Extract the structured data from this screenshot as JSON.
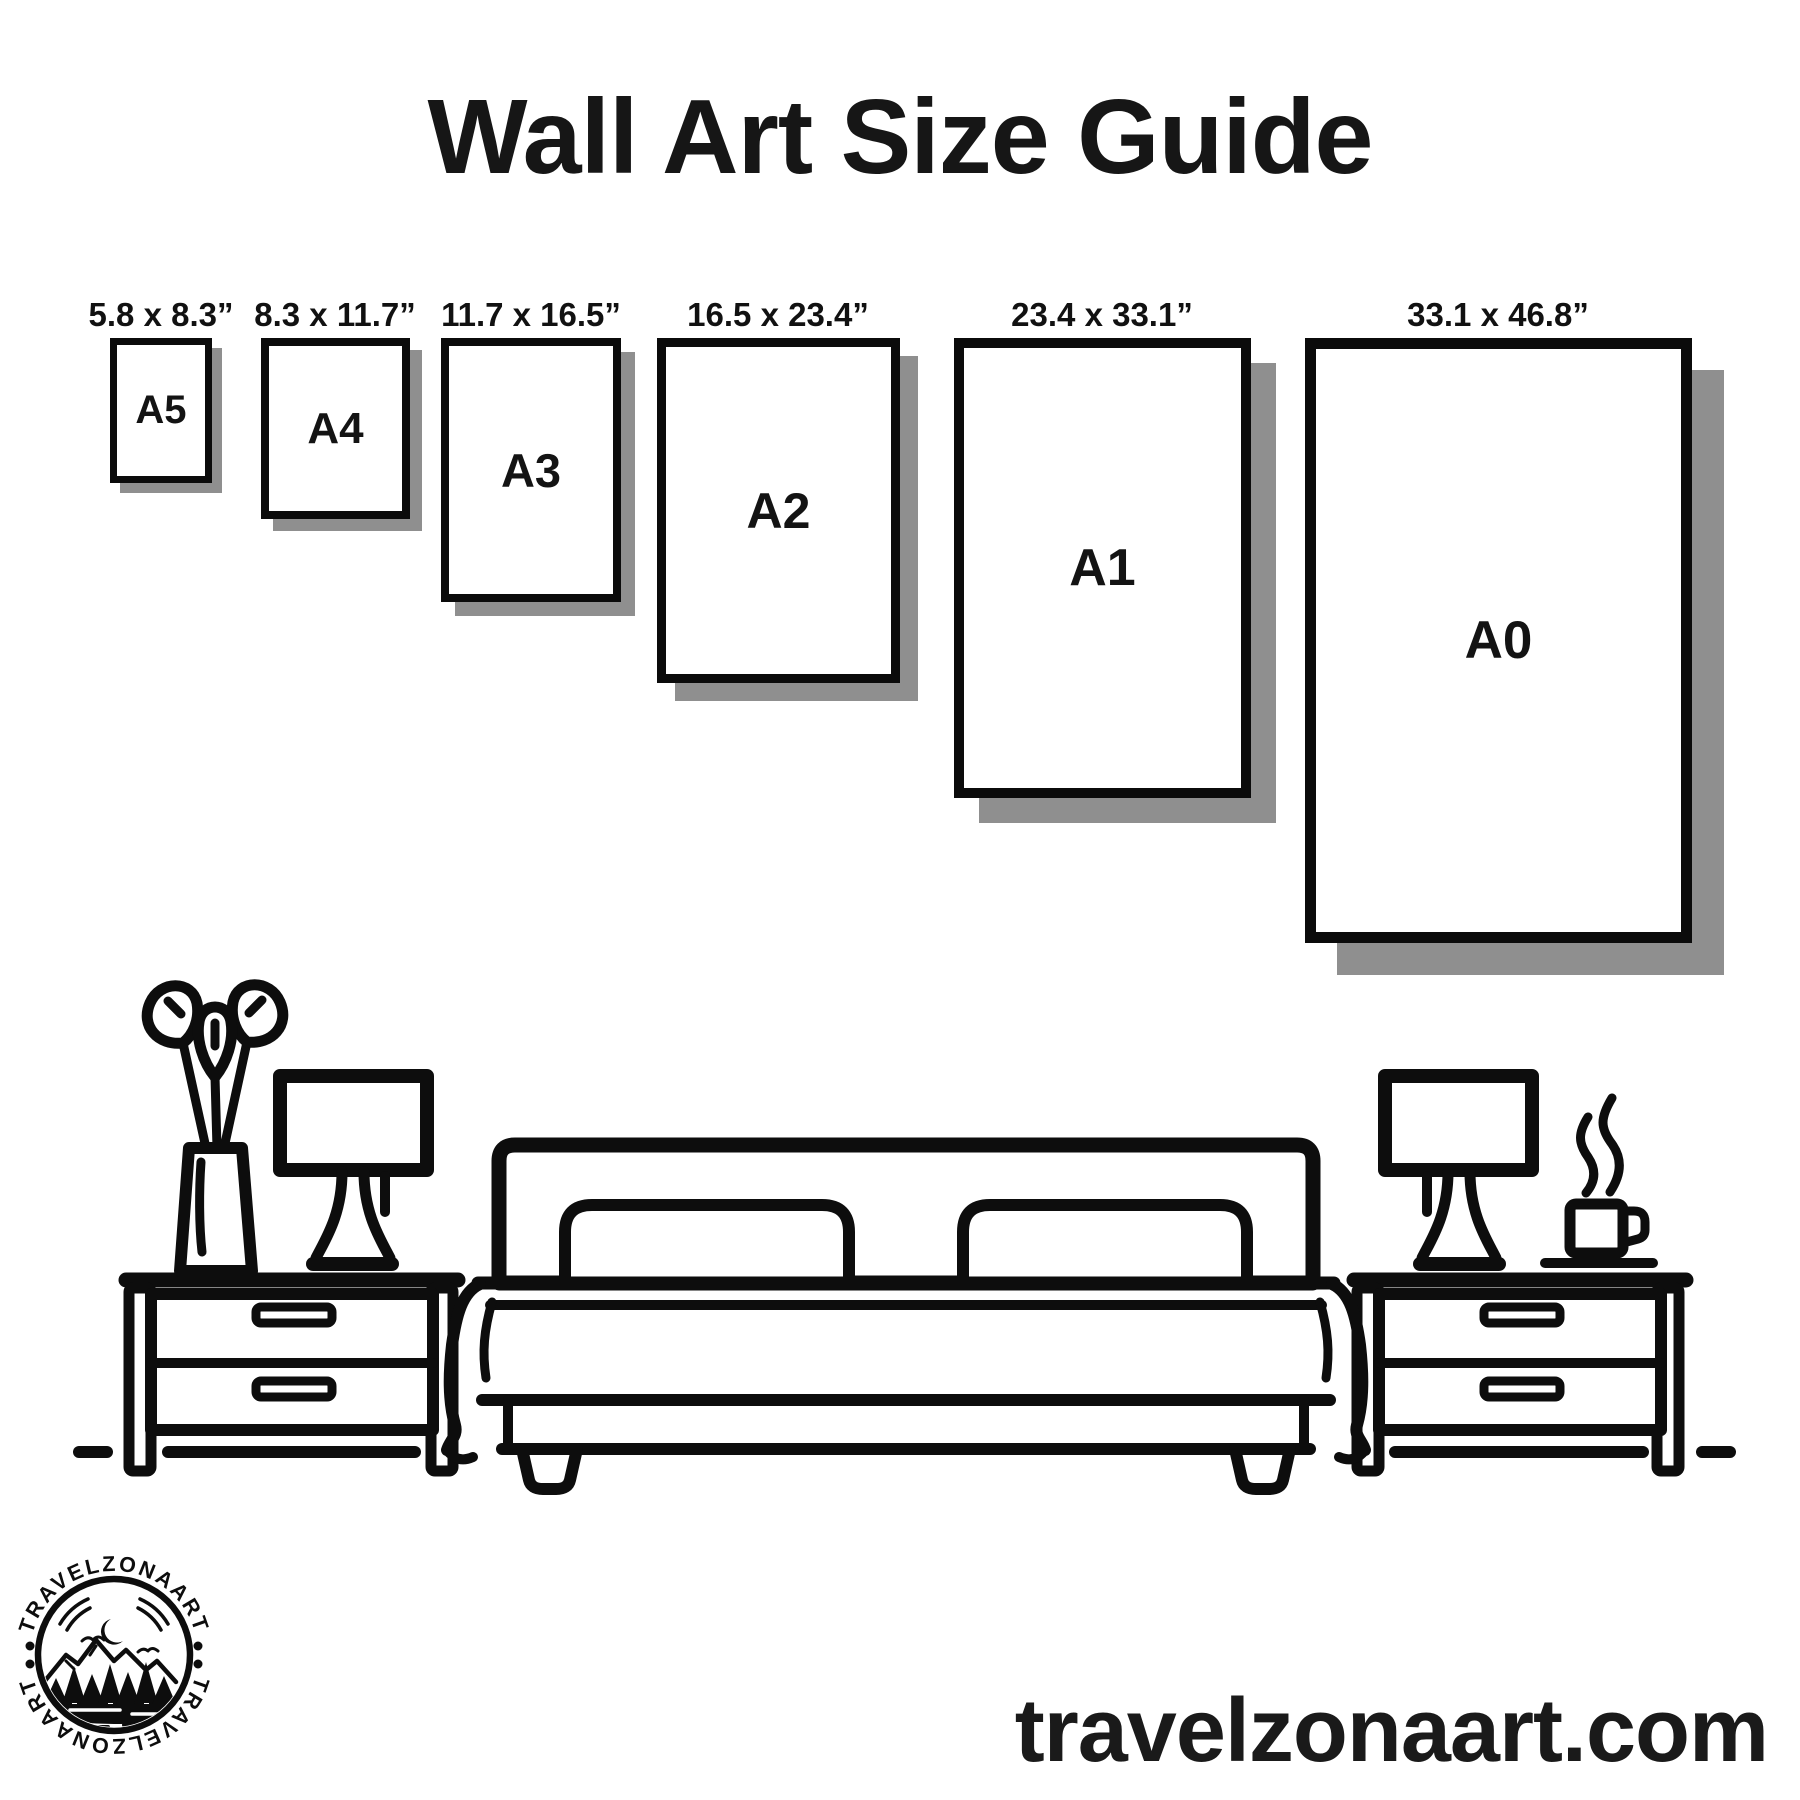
{
  "title": "Wall Art Size Guide",
  "frames": [
    {
      "code": "A5",
      "dimensions": "5.8 x 8.3”"
    },
    {
      "code": "A4",
      "dimensions": "8.3 x 11.7”"
    },
    {
      "code": "A3",
      "dimensions": "11.7 x 16.5”"
    },
    {
      "code": "A2",
      "dimensions": "16.5 x 23.4”"
    },
    {
      "code": "A1",
      "dimensions": "23.4 x 33.1”"
    },
    {
      "code": "A0",
      "dimensions": "33.1 x 46.8”"
    }
  ],
  "website": "travelzonaart.com",
  "logo": {
    "arc_text": "TRAVELZONAART"
  },
  "colors": {
    "ink": "#0d0d0d",
    "shadow": "#8f8f8f",
    "background": "#ffffff"
  }
}
